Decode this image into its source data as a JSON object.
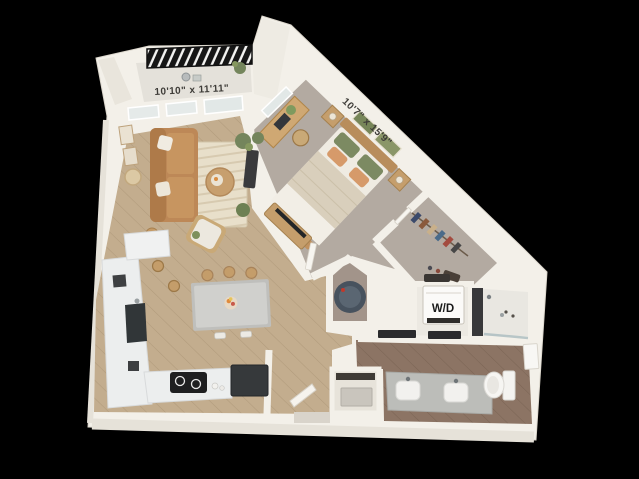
{
  "labels": {
    "living_dimensions": "10'10\" x 11'11\"",
    "bedroom_dimensions": "10'7\" x 15'9\"",
    "washer_dryer": "W/D"
  },
  "palette": {
    "background": "#000000",
    "wall": "#f3f0e9",
    "wall_shade": "#e6e2d9",
    "balcony_floor": "#e4e1da",
    "railing": "#161616",
    "wood_light": "#c3ad8e",
    "wood_dark": "#8c7464",
    "carpet": "#b3aaa1",
    "rug": "#e8dfca",
    "sofa": "#bd8857",
    "island": "#c7c7c4",
    "plant_green": "#74855c",
    "pillow_green": "#7c8a62",
    "pillow_orange": "#d69a6a",
    "water_heater": "#4a5660",
    "appliance_dark": "#36393b",
    "label_text": "#3e3c38"
  }
}
